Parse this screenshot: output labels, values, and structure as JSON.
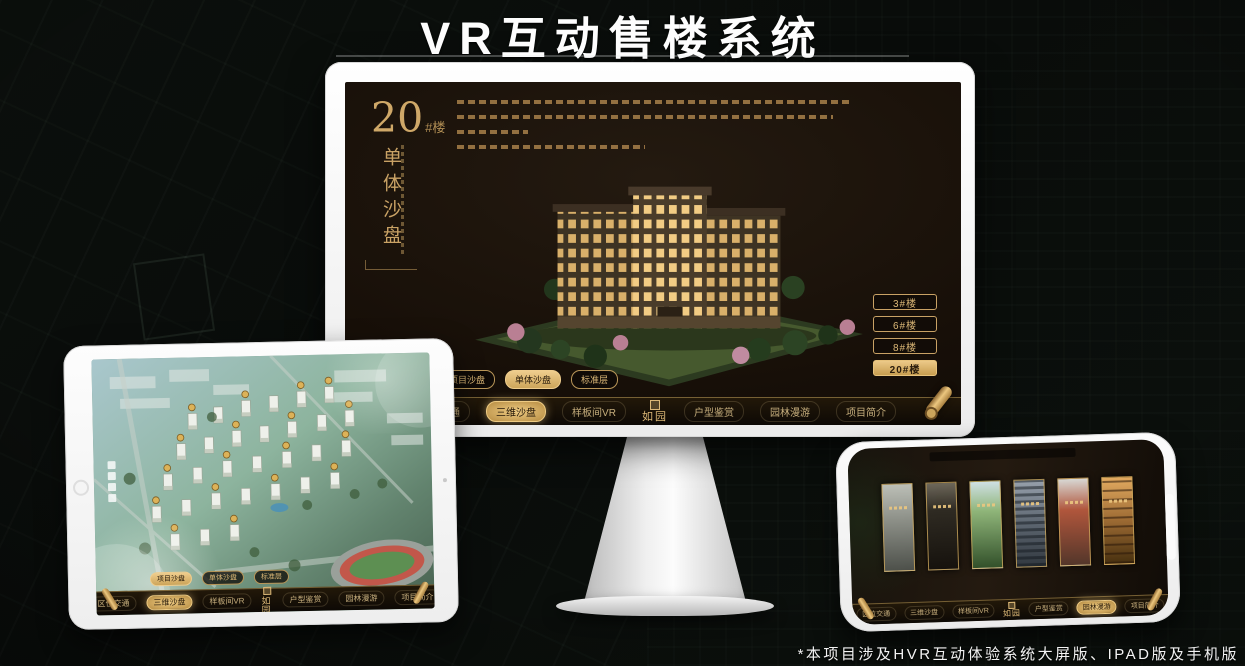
{
  "page": {
    "title": "VR互动售楼系统",
    "footnote": "*本项目涉及HVR互动体验系统大屏版、IPAD版及手机版"
  },
  "colors": {
    "gold": "#c9a265",
    "gold_bright": "#ecc988",
    "screen_dark": "#170f08",
    "background": "#0a0d0b"
  },
  "monitor": {
    "hero": {
      "number": "20",
      "unit": "#楼",
      "subtitle": "单体沙盘"
    },
    "building_buttons": [
      {
        "label": "3#楼",
        "active": false
      },
      {
        "label": "6#楼",
        "active": false
      },
      {
        "label": "8#楼",
        "active": false
      },
      {
        "label": "20#楼",
        "active": true
      }
    ],
    "view_tabs": [
      {
        "label": "项目沙盘",
        "active": false
      },
      {
        "label": "单体沙盘",
        "active": true
      },
      {
        "label": "标准层",
        "active": false
      }
    ],
    "nav": {
      "logo": "如园",
      "items": [
        {
          "label": "区位交通",
          "active": false
        },
        {
          "label": "三维沙盘",
          "active": true
        },
        {
          "label": "样板间VR",
          "active": false
        },
        {
          "label": "户型鉴赏",
          "active": false
        },
        {
          "label": "园林漫游",
          "active": false
        },
        {
          "label": "项目简介",
          "active": false
        }
      ]
    }
  },
  "tablet": {
    "view_tabs": [
      {
        "label": "项目沙盘",
        "active": true
      },
      {
        "label": "单体沙盘",
        "active": false
      },
      {
        "label": "标准层",
        "active": false
      }
    ],
    "nav": {
      "logo": "如园",
      "items": [
        {
          "label": "区位交通",
          "active": false
        },
        {
          "label": "三维沙盘",
          "active": true
        },
        {
          "label": "样板间VR",
          "active": false
        },
        {
          "label": "户型鉴赏",
          "active": false
        },
        {
          "label": "园林漫游",
          "active": false
        },
        {
          "label": "项目简介",
          "active": false
        }
      ]
    }
  },
  "phone": {
    "nav": {
      "logo": "如园",
      "items": [
        {
          "label": "区位交通",
          "active": false
        },
        {
          "label": "三维沙盘",
          "active": false
        },
        {
          "label": "样板间VR",
          "active": false
        },
        {
          "label": "户型鉴赏",
          "active": false
        },
        {
          "label": "园林漫游",
          "active": true
        },
        {
          "label": "项目简介",
          "active": false
        }
      ]
    }
  }
}
